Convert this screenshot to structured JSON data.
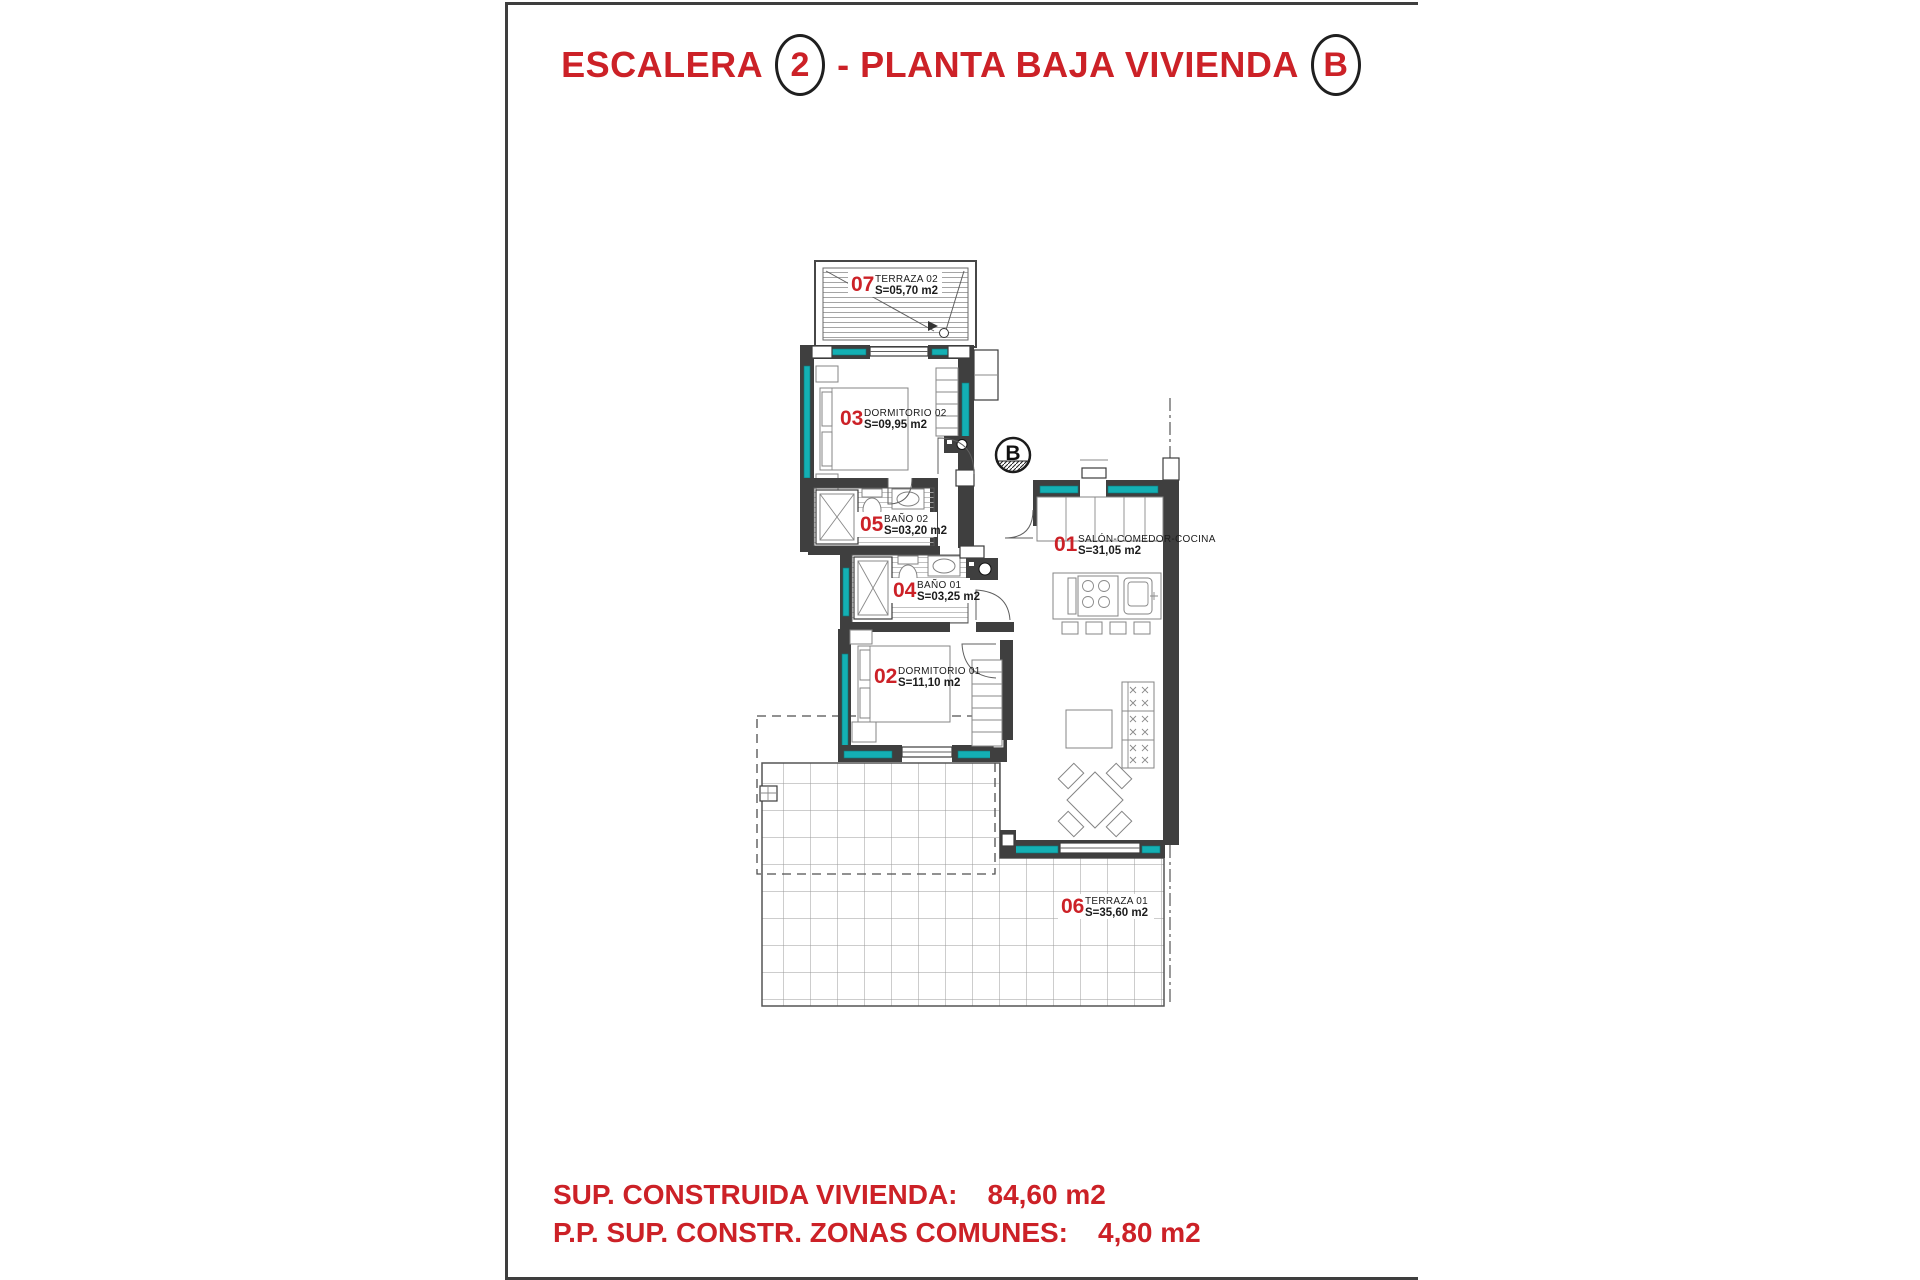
{
  "title": {
    "word1": "ESCALERA",
    "badge1": "2",
    "word2": "- PLANTA BAJA VIVIENDA",
    "badge2": "B"
  },
  "section_marker": "B",
  "rooms": {
    "salon": {
      "num": "01",
      "name": "SALÓN-COMEDOR-COCINA",
      "area": "S=31,05 m2"
    },
    "dormitorio01": {
      "num": "02",
      "name": "DORMITORIO 01",
      "area": "S=11,10 m2"
    },
    "dormitorio02": {
      "num": "03",
      "name": "DORMITORIO 02",
      "area": "S=09,95 m2"
    },
    "banyo01": {
      "num": "04",
      "name": "BAÑO 01",
      "area": "S=03,25 m2"
    },
    "banyo02": {
      "num": "05",
      "name": "BAÑO 02",
      "area": "S=03,20 m2"
    },
    "terraza01": {
      "num": "06",
      "name": "TERRAZA 01",
      "area": "S=35,60 m2"
    },
    "terraza02": {
      "num": "07",
      "name": "TERRAZA 02",
      "area": "S=05,70 m2"
    }
  },
  "summary": {
    "line1": {
      "label": "SUP. CONSTRUIDA VIVIENDA:",
      "value": "84,60 m2"
    },
    "line2": {
      "label": "P.P. SUP. CONSTR. ZONAS COMUNES:",
      "value": "4,80 m2"
    }
  },
  "colors": {
    "accent_red": "#cc2127",
    "wall_gray": "#3f3f3f",
    "window_teal": "#14b0b4"
  }
}
